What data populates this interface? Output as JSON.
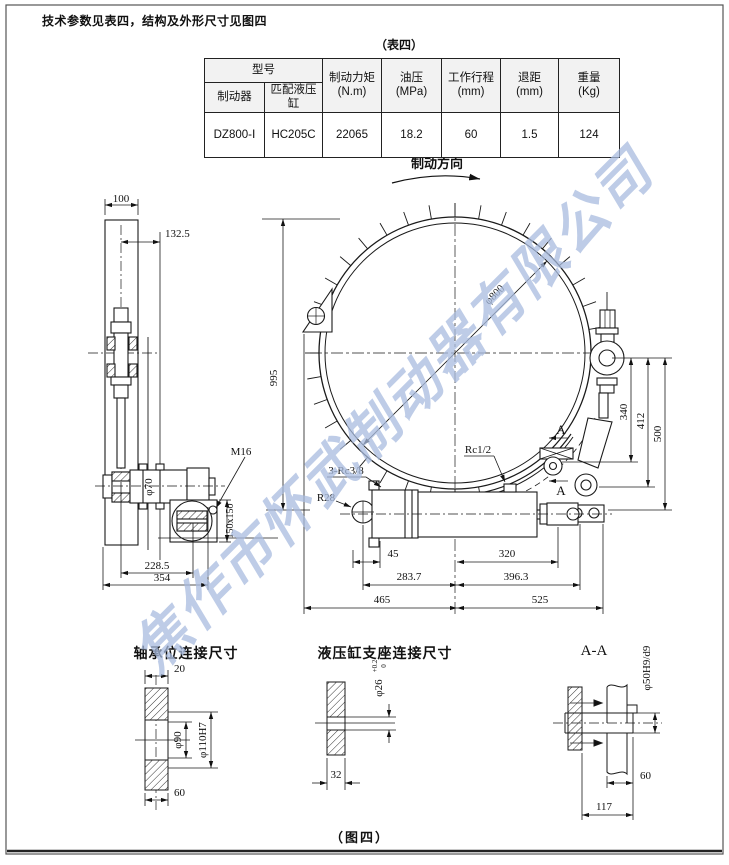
{
  "page": {
    "top_note": "技术参数见表四，结构及外形尺寸见图四",
    "table_caption": "（表四）",
    "figure_caption": "（图四）",
    "watermark": "焦作市怀武制动器有限公司"
  },
  "table": {
    "col_model": "型号",
    "col_brake": "制动器",
    "col_cylinder": "匹配液压缸",
    "col_torque_l1": "制动力矩",
    "col_torque_l2": "(N.m)",
    "col_pressure_l1": "油压",
    "col_pressure_l2": "(MPa)",
    "col_stroke_l1": "工作行程",
    "col_stroke_l2": "(mm)",
    "col_retreat_l1": "退距",
    "col_retreat_l2": "(mm)",
    "col_weight_l1": "重量",
    "col_weight_l2": "(Kg)",
    "row": {
      "brake_model": "DZ800-Ⅰ",
      "cylinder_model": "HC205C",
      "torque": "22065",
      "pressure": "18.2",
      "stroke": "60",
      "retreat": "1.5",
      "weight": "124"
    }
  },
  "main_view": {
    "direction_label": "制动方向",
    "dims": {
      "arm_width": "100",
      "offset": "132.5",
      "height": "995",
      "drum_dia": "φ800",
      "d340": "340",
      "d412": "412",
      "d500": "500",
      "rc12": "Rc1/2",
      "rc38": "3-Rc3/8",
      "r28": "R28",
      "m16": "M16",
      "d45": "45",
      "d320": "320",
      "d2837": "283.7",
      "d3963": "396.3",
      "d465": "465",
      "d525": "525",
      "shaft_dia": "φ70",
      "flange": "150x150",
      "d2285": "228.5",
      "d354": "354",
      "section_mark": "A"
    }
  },
  "details": {
    "bearing": {
      "title": "轴承位连接尺寸",
      "d20": "20",
      "bore1": "φ90",
      "bore2": "φ110H7",
      "d60": "60"
    },
    "support": {
      "title": "液压缸支座连接尺寸",
      "bore": "φ26",
      "tol_up": "+0.2",
      "tol_dn": "0",
      "d32": "32"
    },
    "section": {
      "title": "A-A",
      "bore": "φ50H9/d9",
      "d60": "60",
      "d117": "117"
    }
  }
}
